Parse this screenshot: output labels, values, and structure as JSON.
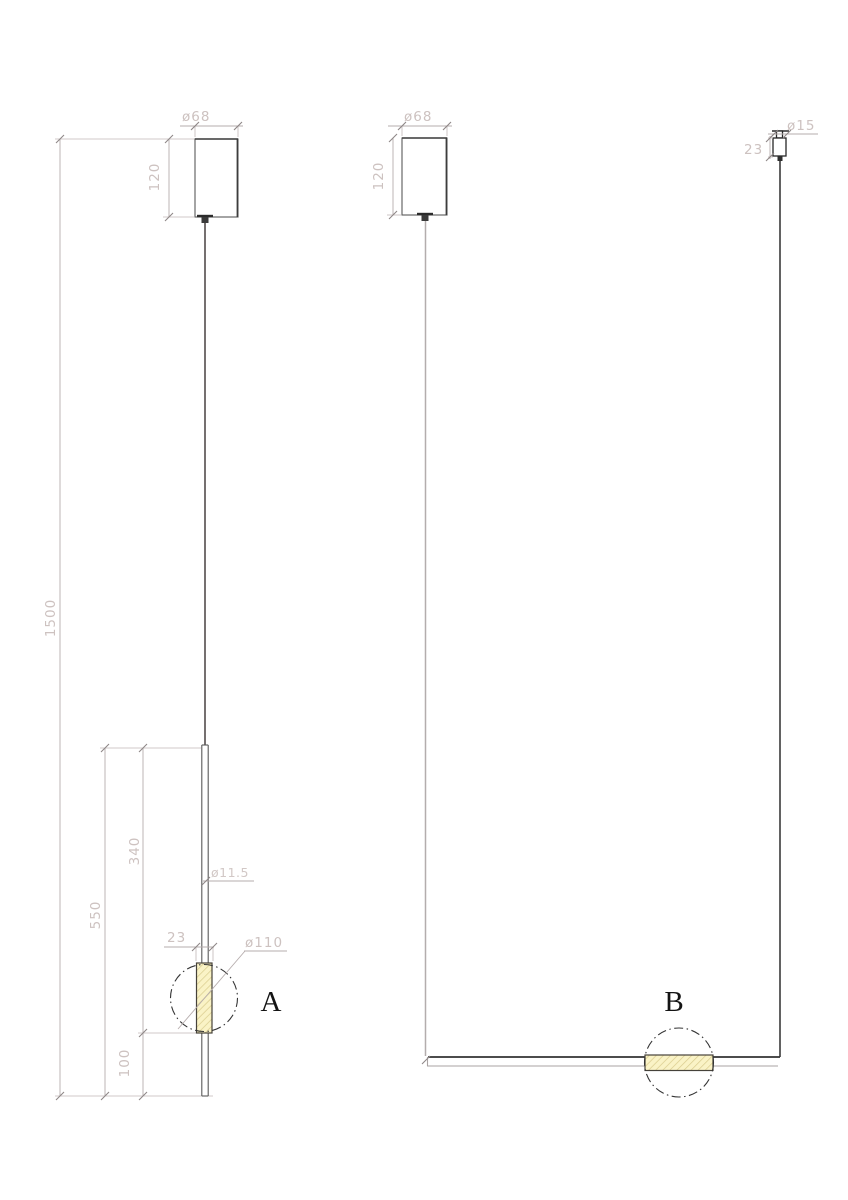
{
  "drawing": {
    "type": "pendant-lamp-dimension-drawing",
    "colors": {
      "object_line": "#3d3d3d",
      "dimension_line": "#b6adad",
      "dimension_text": "#cdc2c0",
      "hatch_fill": "#faf3c6",
      "hatch_stroke": "#d9cb8c",
      "detail_label": "#141414"
    },
    "view_a": {
      "label": "A",
      "canopy_diameter": "ø68",
      "canopy_height": "120",
      "overall_length": "1500",
      "body_length": "550",
      "upper_length": "340",
      "lower_length": "100",
      "rod_diameter": "ø11.5",
      "tube_width": "23",
      "sphere_diameter": "ø110"
    },
    "view_b": {
      "label": "B",
      "canopy_diameter": "ø68",
      "canopy_height": "120",
      "anchor_diameter": "ø15",
      "anchor_height": "23"
    }
  }
}
